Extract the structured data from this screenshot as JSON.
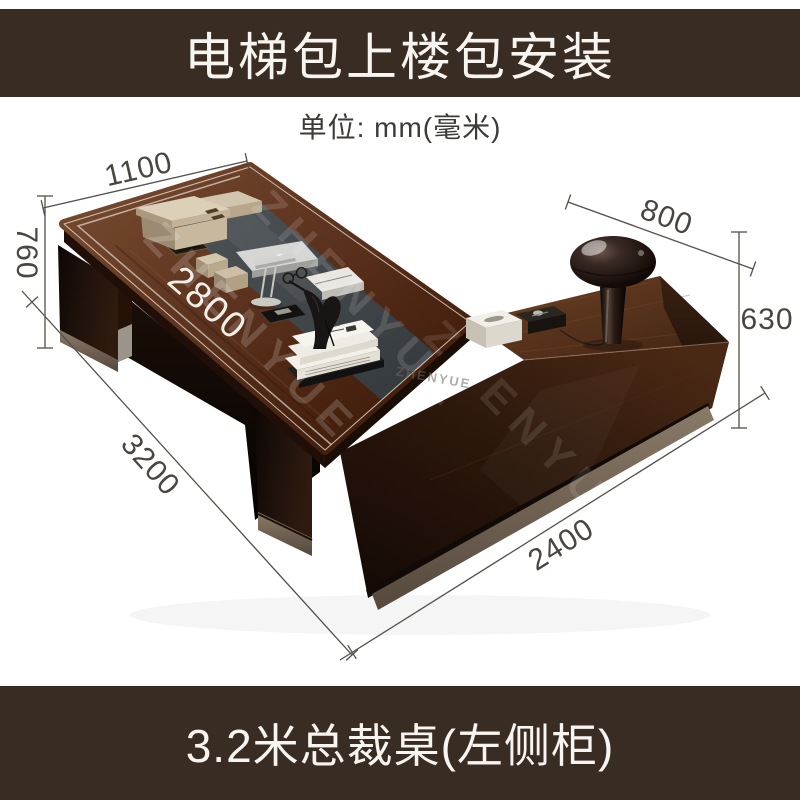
{
  "header": {
    "title": "电梯包上楼包安装"
  },
  "unit_note": "单位: mm(毫米)",
  "dimensions": {
    "desk_end_width": "1100",
    "desk_height": "760",
    "desk_top_length": "2800",
    "cabinet_depth": "800",
    "cabinet_height": "630",
    "desk_total_length": "3200",
    "cabinet_length": "2400"
  },
  "watermark": {
    "brand": "ZHENYUE"
  },
  "footer": {
    "caption": "3.2米总裁桌(左侧柜)"
  },
  "colors": {
    "banner_bg": "#392c23",
    "banner_text": "#f8f5f1",
    "dimension_line": "#54504a",
    "dimension_text": "#4a4541",
    "desk_wood_light": "#7b4e31",
    "desk_wood_dark": "#3a1a0a",
    "glass_inlay": "#3f4448",
    "cabinet_front_dark": "#120905"
  }
}
